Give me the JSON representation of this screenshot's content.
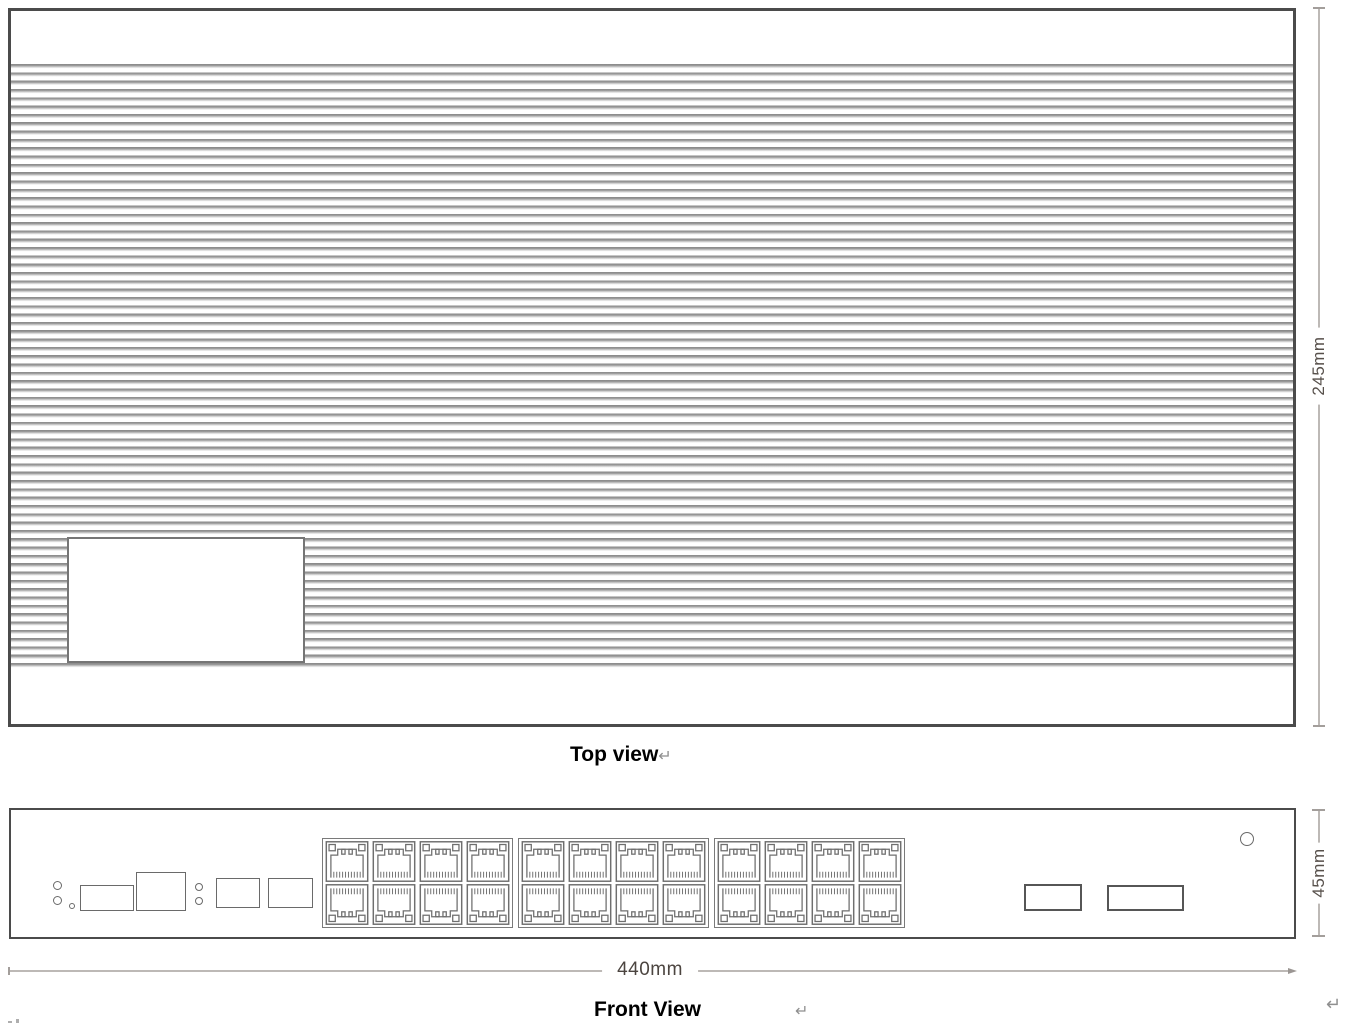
{
  "top_view": {
    "caption": "Top view",
    "paragraph_mark": "↵",
    "height_dimension": "245mm"
  },
  "front_view": {
    "caption": "Front View",
    "paragraph_mark": "↵",
    "trailing_paragraph_mark": "↵",
    "width_dimension": "440mm",
    "height_dimension": "45mm",
    "port_banks": {
      "count": 3,
      "columns": 4,
      "rows": 2,
      "total_ports": 24
    }
  },
  "colors": {
    "chassis_border": "#4b4b4b",
    "fin_line": "#8f8f8f",
    "component_outline": "#6f6f6f",
    "dimension_line": "#bdb9b6",
    "dimension_text": "#57504b",
    "caption_text": "#000000",
    "paragraph_mark": "#8f8f8f"
  }
}
